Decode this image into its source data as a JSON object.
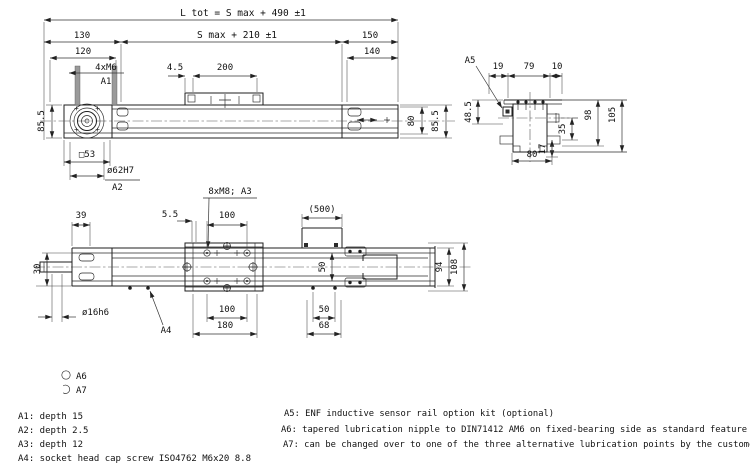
{
  "side_view": {
    "dim_total_length": "L tot = S max + 490 ±1",
    "dim_stroke": "S max + 210 ±1",
    "dim_130": "130",
    "dim_150": "150",
    "dim_120": "120",
    "dim_140": "140",
    "label_screws": "4xM6",
    "ref_a1": "A1",
    "dim_4_5": "4.5",
    "dim_200": "200",
    "dim_height_left": "85.5",
    "dim_height_body": "80",
    "dim_height_right": "85.5",
    "dim_square": "□53",
    "dim_bore": "ø62H7",
    "ref_a2": "A2"
  },
  "end_view": {
    "ref_a5": "A5",
    "dim_19": "19",
    "dim_79": "79",
    "dim_10": "10",
    "dim_48_5": "48.5",
    "dim_98": "98",
    "dim_105": "105",
    "dim_35": "35",
    "dim_17": "17",
    "dim_80": "80"
  },
  "plan_view": {
    "dim_39": "39",
    "dim_5_5": "5.5",
    "label_screws": "8xM8; A3",
    "dim_100_top": "100",
    "dim_500": "(500)",
    "dim_30": "30",
    "dim_50_center": "50",
    "dim_94": "94",
    "dim_108": "108",
    "dim_shaft": "ø16h6",
    "ref_a4": "A4",
    "dim_100_bottom": "100",
    "dim_180": "180",
    "dim_50_right": "50",
    "dim_68": "68"
  },
  "legend": {
    "a6_symbol_label": "A6",
    "a7_symbol_label": "A7",
    "notes_left": [
      "A1: depth 15",
      "A2: depth 2.5",
      "A3: depth 12",
      "A4: socket head cap screw ISO4762 M6x20 8.8"
    ],
    "notes_right": [
      "A5: ENF inductive sensor rail option kit (optional)",
      "A6: tapered lubrication nipple to DIN71412 AM6 on fixed-bearing side as standard feature",
      "A7: can be changed over to one of the three alternative lubrication points by the customer"
    ]
  }
}
